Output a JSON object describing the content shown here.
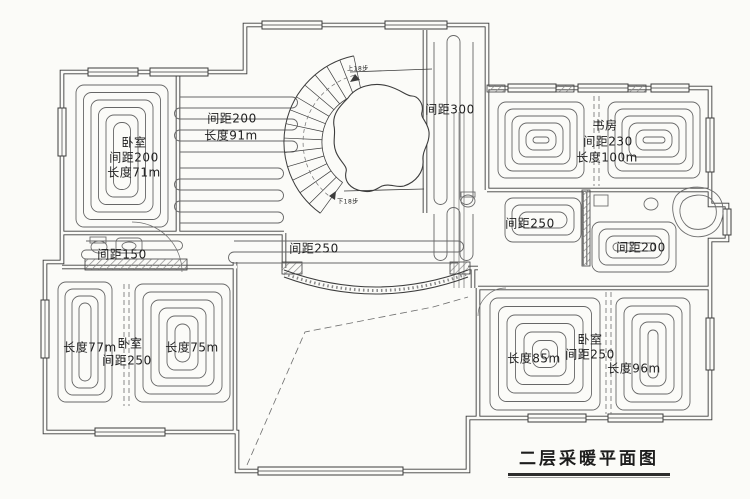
{
  "title": "二层采暖平面图",
  "colors": {
    "paper": "#fbfbf8",
    "wall": "#3c3c3c",
    "coil": "#676767",
    "pipe": "#6e6e6e",
    "hatch": "#8a8a8a",
    "text": "#1f1f1f"
  },
  "annotations": [
    {
      "id": "bedroom-tl-name",
      "text": "卧室",
      "x": 134,
      "y": 143,
      "size": 12
    },
    {
      "id": "bedroom-tl-spacing",
      "text": "间距200",
      "x": 134,
      "y": 158,
      "size": 12
    },
    {
      "id": "bedroom-tl-length",
      "text": "长度71m",
      "x": 134,
      "y": 173,
      "size": 12
    },
    {
      "id": "hallway-spacing",
      "text": "间距200",
      "x": 232,
      "y": 119,
      "size": 12
    },
    {
      "id": "hallway-length",
      "text": "长度91m",
      "x": 231,
      "y": 136,
      "size": 12
    },
    {
      "id": "corridor-left-spacing",
      "text": "间距150",
      "x": 122,
      "y": 255,
      "size": 12
    },
    {
      "id": "hall-center-spacing",
      "text": "间距250",
      "x": 314,
      "y": 249,
      "size": 12
    },
    {
      "id": "stair-corridor-spacing",
      "text": "间距300",
      "x": 450,
      "y": 110,
      "size": 12
    },
    {
      "id": "study-name",
      "text": "书房",
      "x": 605,
      "y": 126,
      "size": 12
    },
    {
      "id": "study-spacing",
      "text": "间距230",
      "x": 608,
      "y": 142,
      "size": 12
    },
    {
      "id": "study-length",
      "text": "长度100m",
      "x": 607,
      "y": 158,
      "size": 12
    },
    {
      "id": "bath-right-spacing",
      "text": "间距250",
      "x": 530,
      "y": 224,
      "size": 12
    },
    {
      "id": "bath-right2-spacing",
      "text": "间距200",
      "x": 641,
      "y": 248,
      "size": 12
    },
    {
      "id": "bedroom-bl-length-left",
      "text": "长度77m",
      "x": 90,
      "y": 348,
      "size": 12
    },
    {
      "id": "bedroom-bl-name",
      "text": "卧室",
      "x": 130,
      "y": 344,
      "size": 12
    },
    {
      "id": "bedroom-bl-spacing",
      "text": "间距250",
      "x": 127,
      "y": 361,
      "size": 12
    },
    {
      "id": "bedroom-bl-length-right",
      "text": "长度75m",
      "x": 192,
      "y": 348,
      "size": 12
    },
    {
      "id": "bedroom-br-name",
      "text": "卧室",
      "x": 590,
      "y": 340,
      "size": 12
    },
    {
      "id": "bedroom-br-spacing",
      "text": "间距250",
      "x": 590,
      "y": 355,
      "size": 12
    },
    {
      "id": "bedroom-br-length-left",
      "text": "长度85m",
      "x": 534,
      "y": 359,
      "size": 12
    },
    {
      "id": "bedroom-br-length-right",
      "text": "长度96m",
      "x": 634,
      "y": 369,
      "size": 12
    },
    {
      "id": "stair-up-steps",
      "text": "上18步",
      "x": 358,
      "y": 69,
      "size": 6
    },
    {
      "id": "stair-down-steps",
      "text": "下18步",
      "x": 348,
      "y": 202,
      "size": 6
    }
  ]
}
